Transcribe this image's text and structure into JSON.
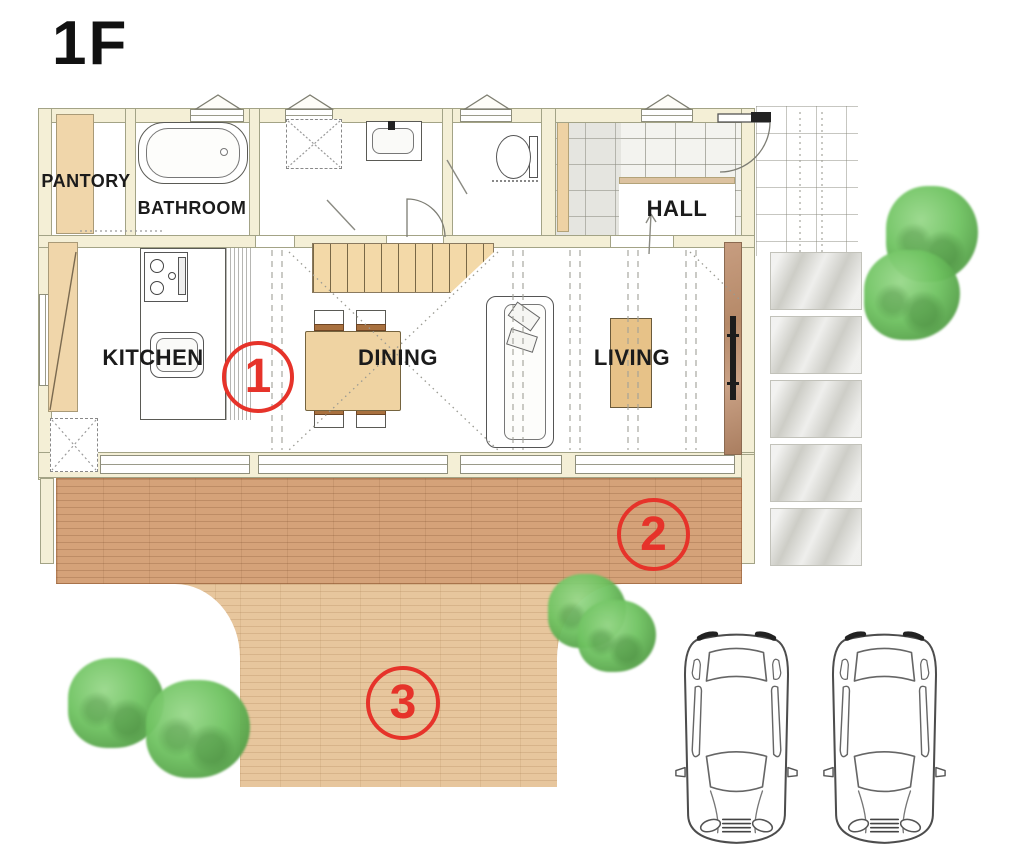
{
  "title": "1F",
  "rooms": {
    "pantry": "PANTORY",
    "bathroom": "BATHROOM",
    "hall": "HALL",
    "kitchen": "KITCHEN",
    "dining": "DINING",
    "living": "LIVING"
  },
  "markers": [
    {
      "label": "1"
    },
    {
      "label": "2"
    },
    {
      "label": "3"
    }
  ],
  "colors": {
    "marker_red": "#e6332a",
    "wall_cream": "#f4efd6",
    "wood_tan": "#f3d9a8",
    "deck_brown": "#d5a279",
    "approach_tan": "#e7c69d",
    "tree_green": "#6fc361",
    "stone_gray": "#dbdbd6",
    "accent_wall_brown": "#c49a7b"
  }
}
